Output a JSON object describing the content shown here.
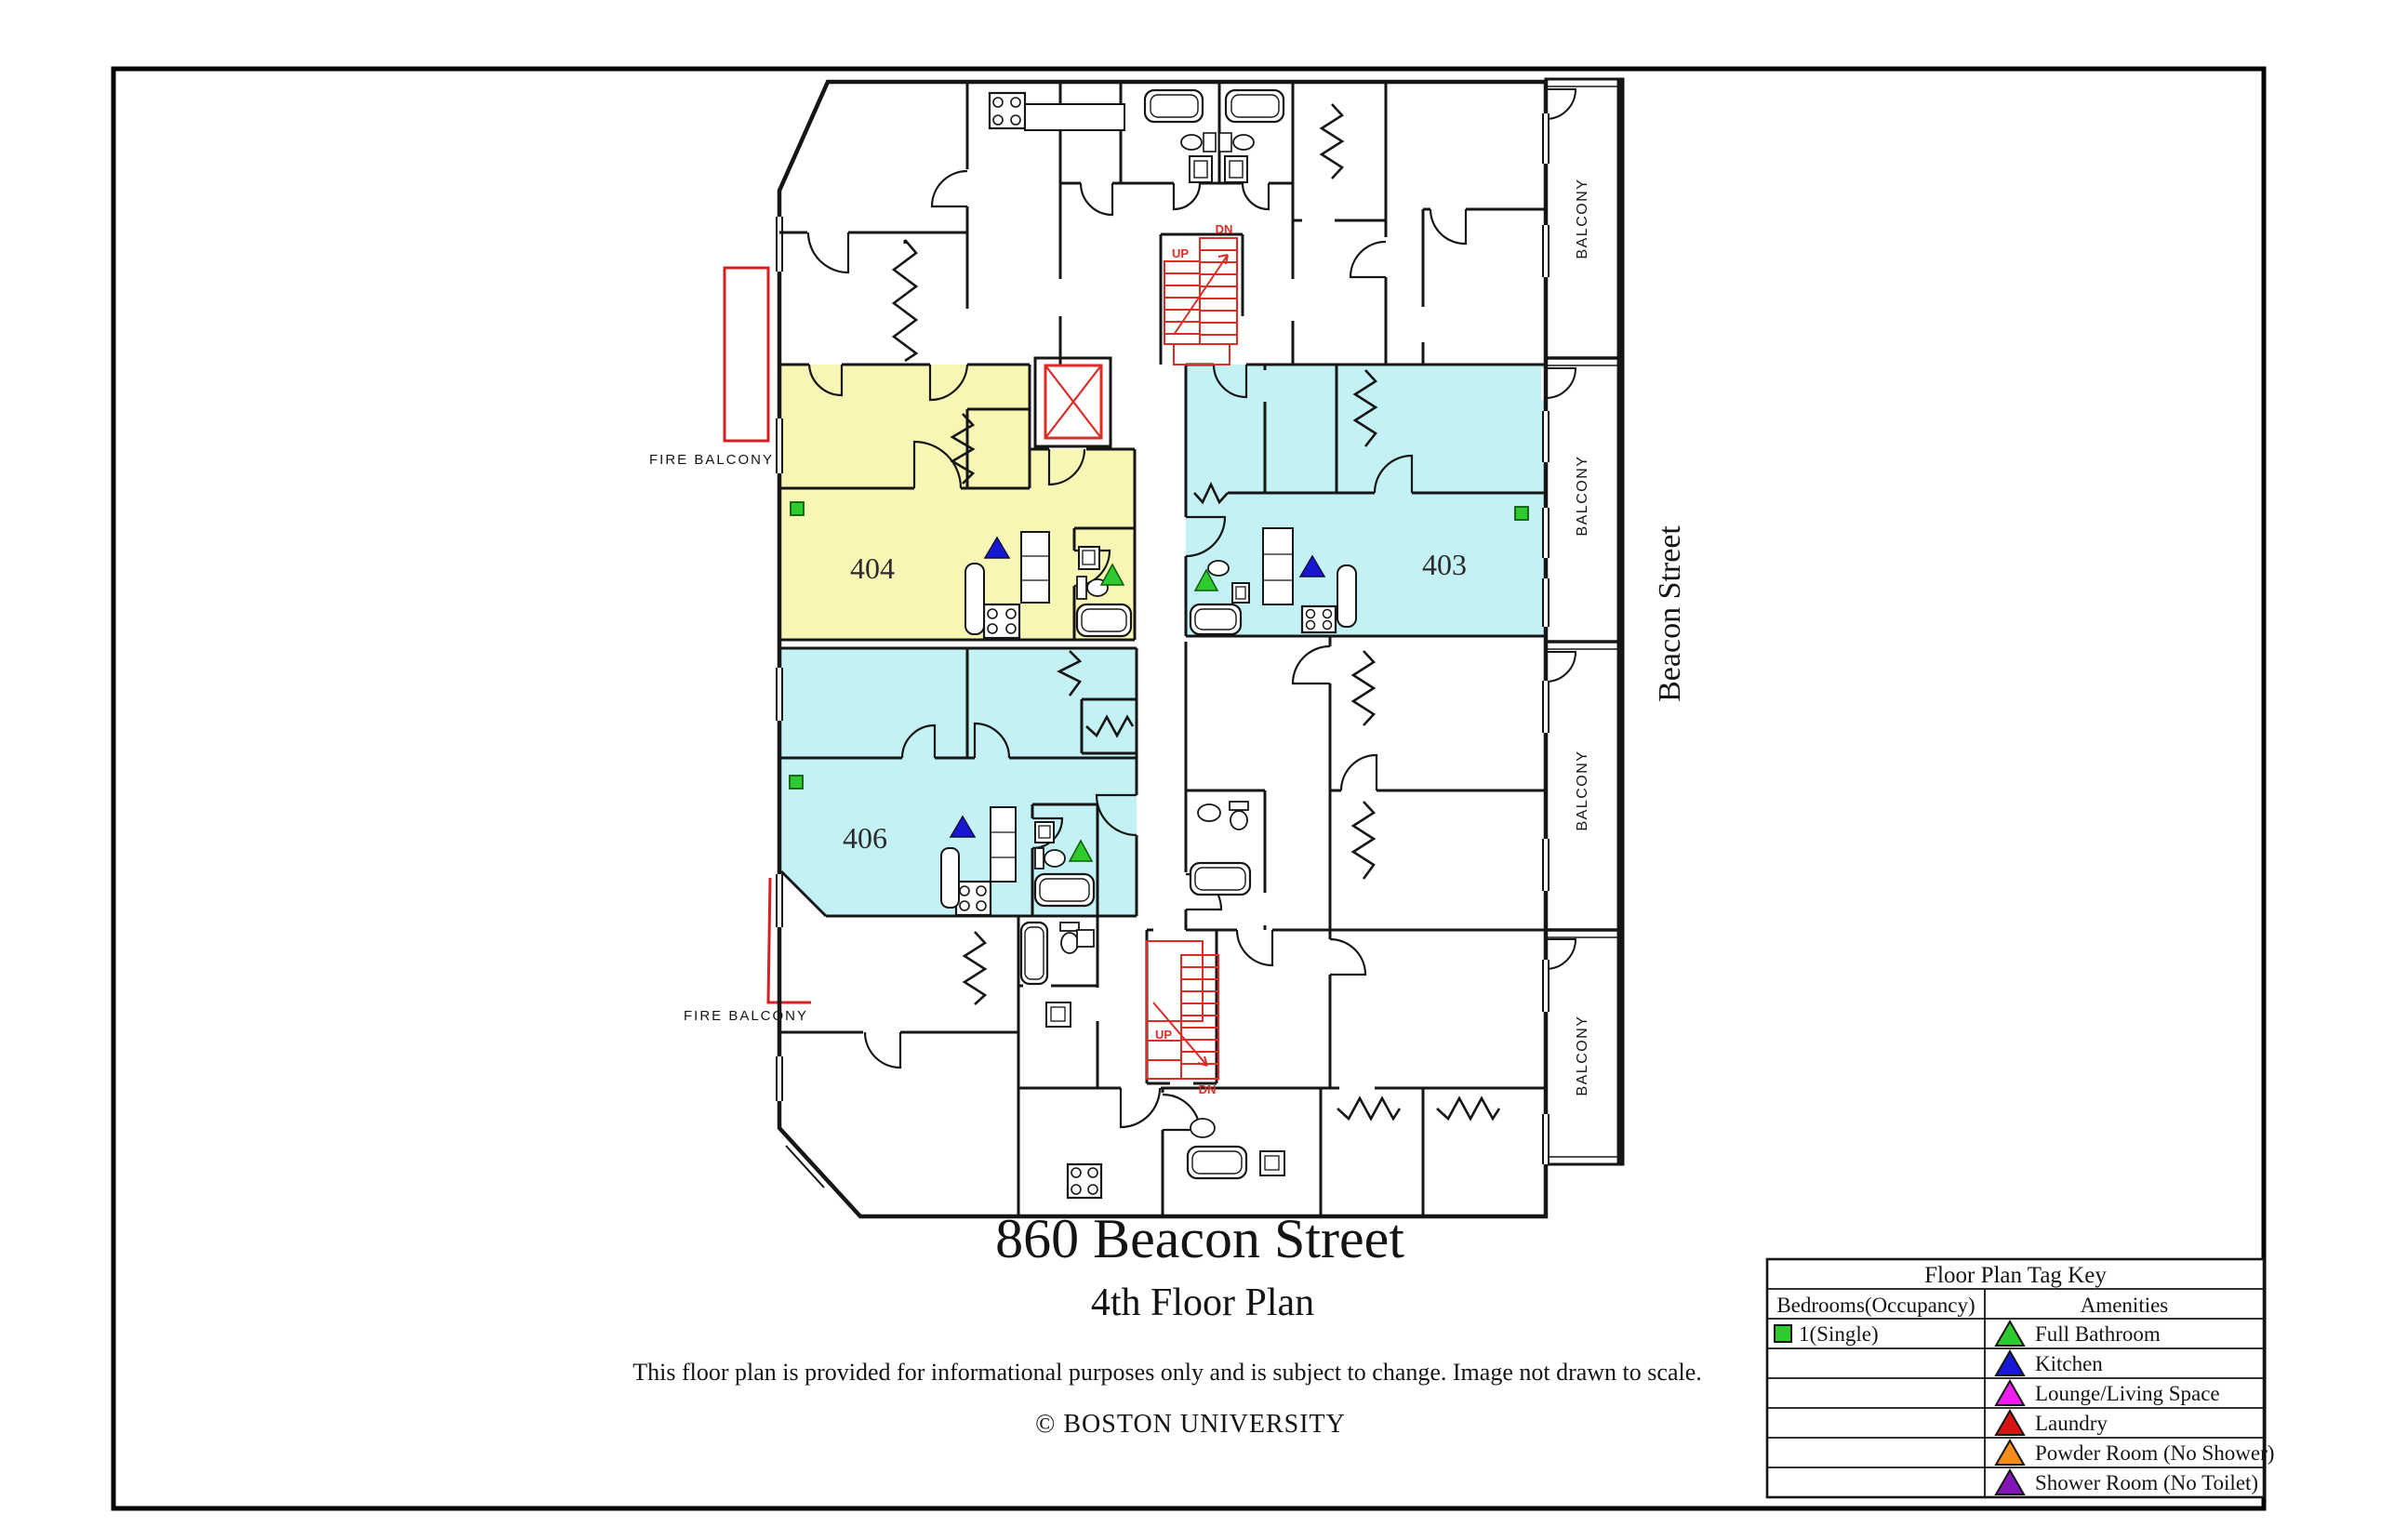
{
  "page": {
    "title": "860 Beacon Street",
    "subtitle": "4th Floor Plan",
    "disclaimer": "This floor plan is provided for informational purposes only and is subject to change. Image not drawn to scale.",
    "copyright": "© BOSTON UNIVERSITY"
  },
  "plan": {
    "street": "Beacon Street",
    "balcony_label": "BALCONY",
    "fire_balcony_label": "FIRE BALCONY",
    "stairs": {
      "up": "UP",
      "down": "DN"
    },
    "units": [
      {
        "number": "404",
        "highlight": "yellow",
        "occupancy": "1(Single)",
        "amenities": [
          "Kitchen",
          "Full Bathroom"
        ]
      },
      {
        "number": "403",
        "highlight": "cyan",
        "occupancy": "1(Single)",
        "amenities": [
          "Kitchen",
          "Full Bathroom"
        ]
      },
      {
        "number": "406",
        "highlight": "cyan",
        "occupancy": "1(Single)",
        "amenities": [
          "Kitchen",
          "Full Bathroom"
        ]
      }
    ],
    "colors": {
      "wall": "#161616",
      "highlight_yellow": "#f8f6b4",
      "highlight_cyan": "#c4f1f3",
      "stairs_red": "#de2b26",
      "fire_balcony_red": "#d42020"
    }
  },
  "legend": {
    "title": "Floor Plan Tag Key",
    "col_bedrooms": "Bedrooms(Occupancy)",
    "col_amenities": "Amenities",
    "bedroom_types": [
      {
        "label": "1(Single)",
        "color": "#2eca2e",
        "shape": "square"
      }
    ],
    "amenities": [
      {
        "label": "Full Bathroom",
        "color": "#2eca2e"
      },
      {
        "label": "Kitchen",
        "color": "#1717d4"
      },
      {
        "label": "Lounge/Living Space",
        "color": "#ee1fee"
      },
      {
        "label": "Laundry",
        "color": "#d91414"
      },
      {
        "label": "Powder Room (No Shower)",
        "color": "#f68c1c"
      },
      {
        "label": "Shower Room (No Toilet)",
        "color": "#8316b6"
      }
    ]
  }
}
